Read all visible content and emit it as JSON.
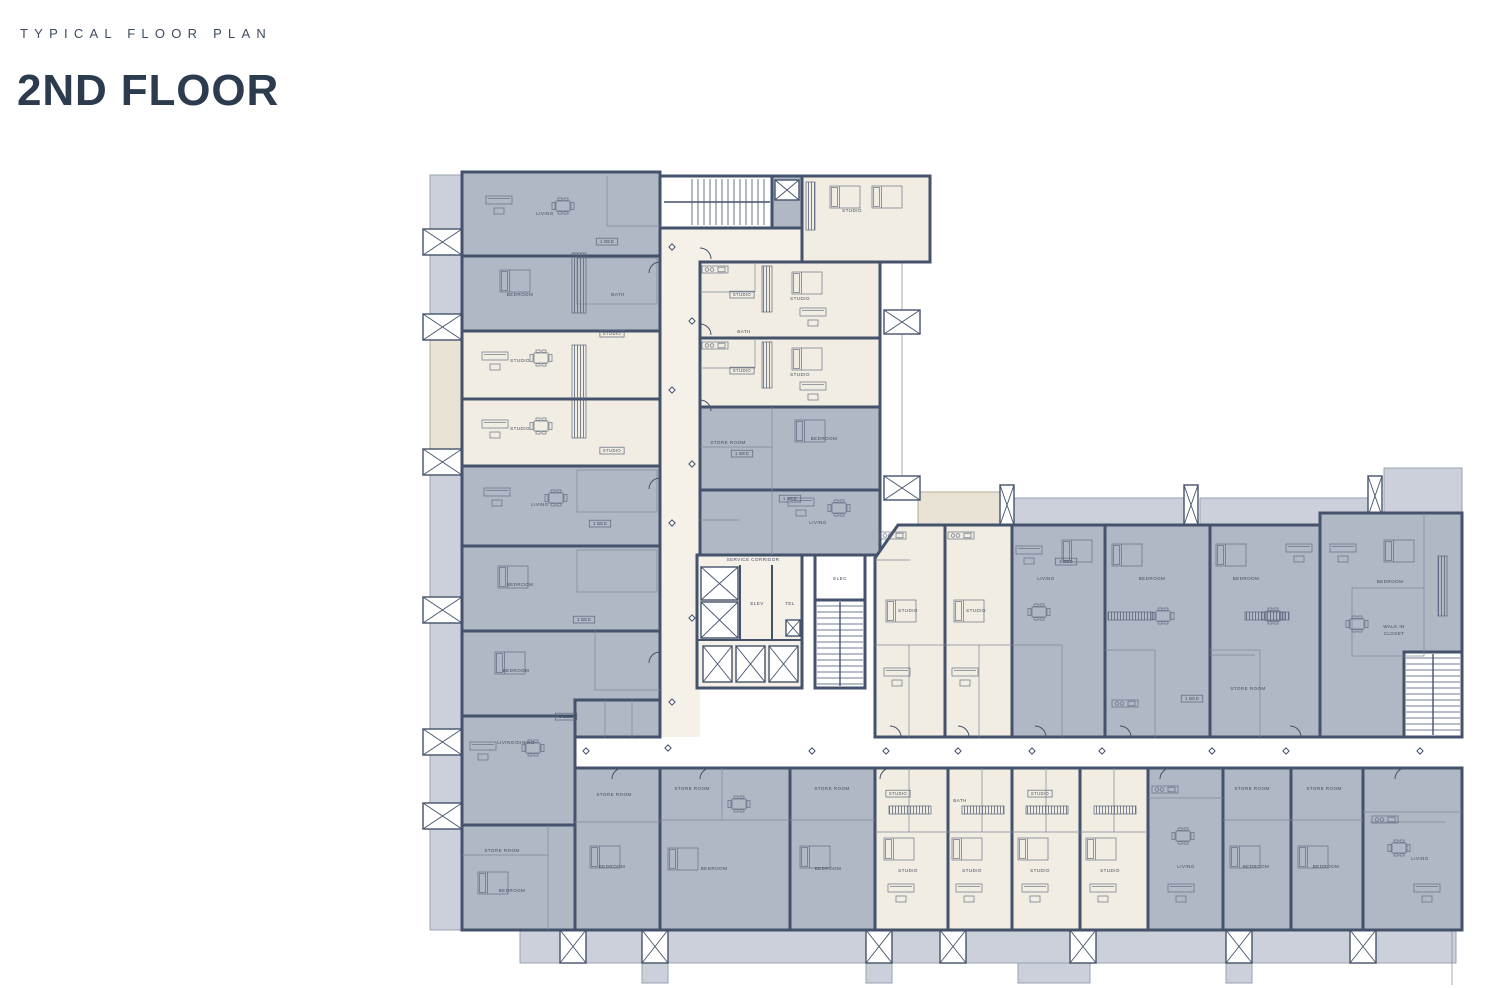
{
  "header": {
    "eyebrow": "TYPICAL FLOOR PLAN",
    "title": "2ND FLOOR"
  },
  "colors": {
    "wall": "#44526b",
    "unit_gray": "#b1b8c5",
    "unit_cream": "#f2ede2",
    "balcony_gray": "#cbd0da",
    "balcony_cream": "#e9e3d6",
    "corridor": "#f5f1e9",
    "title_text": "#2d3b4f"
  },
  "plan": {
    "labels": [
      {
        "t": "LIVING",
        "x": 545,
        "y": 215
      },
      {
        "t": "BEDROOM",
        "x": 520,
        "y": 296
      },
      {
        "t": "STUDIO",
        "x": 520,
        "y": 362
      },
      {
        "t": "STUDIO",
        "x": 520,
        "y": 430
      },
      {
        "t": "LIVING",
        "x": 540,
        "y": 506
      },
      {
        "t": "BEDROOM",
        "x": 520,
        "y": 586
      },
      {
        "t": "BEDROOM",
        "x": 516,
        "y": 672
      },
      {
        "t": "LIVING/DINING",
        "x": 516,
        "y": 744
      },
      {
        "t": "STORE ROOM",
        "x": 502,
        "y": 852
      },
      {
        "t": "BEDROOM",
        "x": 512,
        "y": 892
      },
      {
        "t": "STUDIO",
        "x": 852,
        "y": 212
      },
      {
        "t": "STUDIO",
        "x": 800,
        "y": 300
      },
      {
        "t": "STUDIO",
        "x": 800,
        "y": 376
      },
      {
        "t": "STORE ROOM",
        "x": 728,
        "y": 444
      },
      {
        "t": "BEDROOM",
        "x": 824,
        "y": 440
      },
      {
        "t": "LIVING",
        "x": 818,
        "y": 524
      },
      {
        "t": "SERVICE CORRIDOR",
        "x": 753,
        "y": 561
      },
      {
        "t": "ELEV",
        "x": 757,
        "y": 605
      },
      {
        "t": "TEL",
        "x": 790,
        "y": 605
      },
      {
        "t": "ELEC",
        "x": 840,
        "y": 580
      },
      {
        "t": "STUDIO",
        "x": 908,
        "y": 612
      },
      {
        "t": "STUDIO",
        "x": 976,
        "y": 612
      },
      {
        "t": "LIVING",
        "x": 1046,
        "y": 580
      },
      {
        "t": "BEDROOM",
        "x": 1152,
        "y": 580
      },
      {
        "t": "BEDROOM",
        "x": 1246,
        "y": 580
      },
      {
        "t": "STORE ROOM",
        "x": 1248,
        "y": 690
      },
      {
        "t": "BEDROOM",
        "x": 1390,
        "y": 583
      },
      {
        "t": "WALK IN",
        "x": 1394,
        "y": 628
      },
      {
        "t": "CLOSET",
        "x": 1394,
        "y": 635
      },
      {
        "t": "STORE ROOM",
        "x": 614,
        "y": 796
      },
      {
        "t": "BEDROOM",
        "x": 612,
        "y": 868
      },
      {
        "t": "STORE ROOM",
        "x": 692,
        "y": 790
      },
      {
        "t": "BEDROOM",
        "x": 714,
        "y": 870
      },
      {
        "t": "STORE ROOM",
        "x": 832,
        "y": 790
      },
      {
        "t": "BEDROOM",
        "x": 828,
        "y": 870
      },
      {
        "t": "STUDIO",
        "x": 908,
        "y": 872
      },
      {
        "t": "STUDIO",
        "x": 972,
        "y": 872
      },
      {
        "t": "STUDIO",
        "x": 1040,
        "y": 872
      },
      {
        "t": "STUDIO",
        "x": 1110,
        "y": 872
      },
      {
        "t": "LIVING",
        "x": 1186,
        "y": 868
      },
      {
        "t": "STORE ROOM",
        "x": 1252,
        "y": 790
      },
      {
        "t": "BEDROOM",
        "x": 1256,
        "y": 868
      },
      {
        "t": "STORE ROOM",
        "x": 1324,
        "y": 790
      },
      {
        "t": "BEDROOM",
        "x": 1326,
        "y": 868
      },
      {
        "t": "LIVING",
        "x": 1420,
        "y": 860
      },
      {
        "t": "BATH",
        "x": 618,
        "y": 296
      },
      {
        "t": "BATH",
        "x": 744,
        "y": 333
      },
      {
        "t": "BATH",
        "x": 960,
        "y": 802
      }
    ],
    "tags": [
      {
        "t": "1 BED",
        "x": 607,
        "y": 243
      },
      {
        "t": "STUDIO",
        "x": 612,
        "y": 335
      },
      {
        "t": "STUDIO",
        "x": 612,
        "y": 452
      },
      {
        "t": "1 BED",
        "x": 600,
        "y": 525
      },
      {
        "t": "1 BED",
        "x": 584,
        "y": 621
      },
      {
        "t": "STUDIO",
        "x": 742,
        "y": 296
      },
      {
        "t": "STUDIO",
        "x": 742,
        "y": 372
      },
      {
        "t": "1 BED",
        "x": 742,
        "y": 455
      },
      {
        "t": "1 BED",
        "x": 790,
        "y": 500
      },
      {
        "t": "1 BED",
        "x": 566,
        "y": 718
      },
      {
        "t": "STUDIO",
        "x": 898,
        "y": 795
      },
      {
        "t": "STUDIO",
        "x": 1040,
        "y": 795
      },
      {
        "t": "1 BED",
        "x": 1066,
        "y": 563
      },
      {
        "t": "1 BED",
        "x": 1192,
        "y": 700
      }
    ]
  }
}
